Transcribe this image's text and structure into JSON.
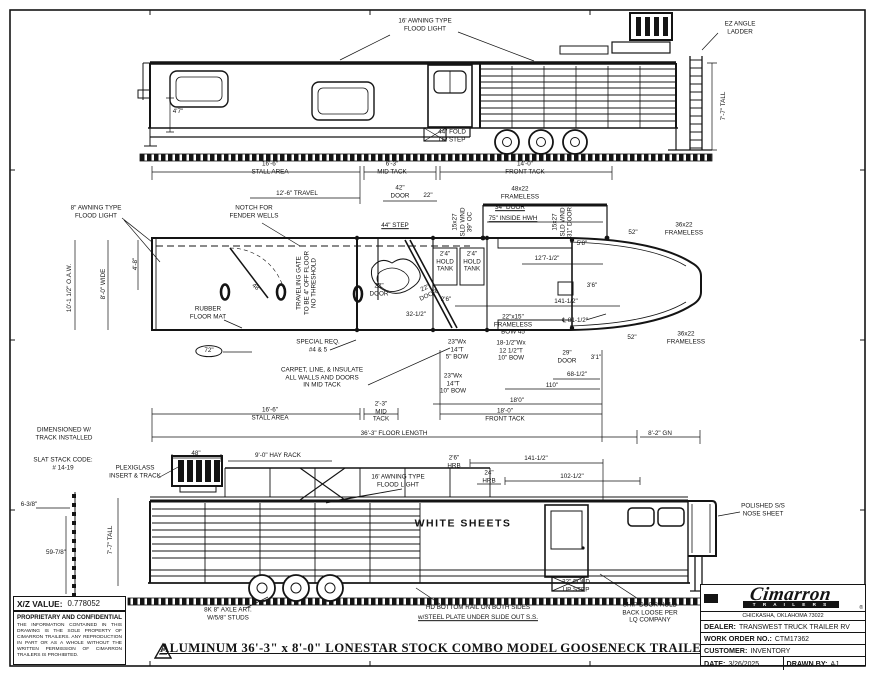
{
  "sheet": {
    "title": "ALUMINUM 36'-3\" x 8'-0\" LONESTAR STOCK COMBO MODEL GOOSENECK TRAILER",
    "xz_label": "X/Z VALUE:",
    "xz_value": "0.778052",
    "proprietary_title": "PROPRIETARY AND CONFIDENTIAL",
    "proprietary_text": "THE INFORMATION CONTAINED IN THIS DRAWING IS THE SOLE PROPERTY OF CIMARRON TRAILERS. ANY REPRODUCTION IN PART OR AS A WHOLE WITHOUT THE WRITTEN PERMISSION OF CIMARRON TRAILERS IS PROHIBITED."
  },
  "title_block": {
    "brand": "Cimarron",
    "brand_sub": "T R A I L E R S",
    "brand_reg": "®",
    "address": "CHICKASHA, OKLAHOMA 73022",
    "dealer_label": "DEALER:",
    "dealer": "TRANSWEST TRUCK TRAILER RV",
    "work_order_label": "WORK ORDER NO.:",
    "work_order": "CTM17362",
    "customer_label": "CUSTOMER:",
    "customer": "INVENTORY",
    "date_label": "DATE:",
    "date": "3/26/2025",
    "drawn_by_label": "DRAWN BY:",
    "drawn_by": "AJ"
  },
  "colors": {
    "ink": "#141414",
    "paper": "#ffffff"
  },
  "annotations": [
    {
      "text": "16' AWNING TYPE\nFLOOD LIGHT",
      "x": 425,
      "y": 25
    },
    {
      "text": "EZ ANGLE\nLADDER",
      "x": 740,
      "y": 28
    },
    {
      "text": "7'-7\" TALL",
      "x": 724,
      "y": 106,
      "rot": -90
    },
    {
      "text": "44\" FOLD\nUP STEP",
      "x": 452,
      "y": 136
    },
    {
      "text": "4'7\"",
      "x": 178,
      "y": 112
    },
    {
      "text": "16'-6\"\nSTALL AREA",
      "x": 270,
      "y": 168
    },
    {
      "text": "6'-3\"\nMID TACK",
      "x": 392,
      "y": 168
    },
    {
      "text": "14'-0\"\nFRONT TACK",
      "x": 525,
      "y": 168
    },
    {
      "text": "12'-6\" TRAVEL",
      "x": 297,
      "y": 194
    },
    {
      "text": "42\"\nDOOR",
      "x": 400,
      "y": 192
    },
    {
      "text": "22\"",
      "x": 428,
      "y": 196
    },
    {
      "text": "48x22\nFRAMELESS",
      "x": 520,
      "y": 193
    },
    {
      "text": "34\" DOOR",
      "x": 510,
      "y": 208,
      "style": "u"
    },
    {
      "text": "75\" INSIDE HWH",
      "x": 513,
      "y": 219,
      "style": "u"
    },
    {
      "text": "15x27\nSLD WND\n39\" OC",
      "x": 463,
      "y": 222,
      "rot": -90
    },
    {
      "text": "15x27\nSLD WND\n31\" DOOR",
      "x": 563,
      "y": 222,
      "rot": -90
    },
    {
      "text": "12'7-1/2\"",
      "x": 547,
      "y": 259
    },
    {
      "text": "8\" AWNING TYPE\nFLOOD LIGHT",
      "x": 96,
      "y": 212
    },
    {
      "text": "NOTCH FOR\nFENDER WELLS",
      "x": 254,
      "y": 212
    },
    {
      "text": "10'-1 1/2\" O.A.W.",
      "x": 70,
      "y": 288,
      "rot": -90
    },
    {
      "text": "8'-0\" WIDE",
      "x": 104,
      "y": 284,
      "rot": -90
    },
    {
      "text": "4'-8\"",
      "x": 136,
      "y": 264,
      "rot": -90
    },
    {
      "text": "48\"",
      "x": 256,
      "y": 288,
      "rot": 40
    },
    {
      "text": "TRAVELING GATE\nTO BE 4\" OFF FLOOR\nNO THRESHOLD",
      "x": 307,
      "y": 283,
      "rot": -90
    },
    {
      "text": "RUBBER\nFLOOR MAT",
      "x": 208,
      "y": 313
    },
    {
      "text": "72\"",
      "x": 209,
      "y": 351,
      "style": "balloon"
    },
    {
      "text": "SPECIAL REQ.\n#4 & 5",
      "x": 318,
      "y": 346
    },
    {
      "text": "CARPET, LINE, & INSULATE\nALL WALLS AND DOORS\nIN MID TACK",
      "x": 322,
      "y": 378
    },
    {
      "text": "2'4\"\nHOLD\nTANK",
      "x": 445,
      "y": 262
    },
    {
      "text": "2'4\"\nHOLD\nTANK",
      "x": 472,
      "y": 262
    },
    {
      "text": "44\" STEP",
      "x": 395,
      "y": 226,
      "style": "u"
    },
    {
      "text": "22\"\nDOOR",
      "x": 379,
      "y": 290
    },
    {
      "text": "22\"\nDOOR",
      "x": 427,
      "y": 292,
      "rot": -25
    },
    {
      "text": "32-1/2\"",
      "x": 416,
      "y": 315
    },
    {
      "text": "2'6\"",
      "x": 446,
      "y": 300
    },
    {
      "text": "141-1/2\"",
      "x": 566,
      "y": 302
    },
    {
      "text": "22\"x15\"\nFRAMELESS\nBOW 45",
      "x": 513,
      "y": 325
    },
    {
      "text": "℄ 81-1/2\"",
      "x": 575,
      "y": 321
    },
    {
      "text": "3'6\"",
      "x": 592,
      "y": 286
    },
    {
      "text": "5'8\"",
      "x": 582,
      "y": 244
    },
    {
      "text": "52\"",
      "x": 633,
      "y": 233
    },
    {
      "text": "36x22\nFRAMELESS",
      "x": 684,
      "y": 229
    },
    {
      "text": "52\"",
      "x": 632,
      "y": 338
    },
    {
      "text": "36x22\nFRAMELESS",
      "x": 686,
      "y": 338
    },
    {
      "text": "29\"\nDOOR",
      "x": 567,
      "y": 357
    },
    {
      "text": "3'1\"",
      "x": 596,
      "y": 358
    },
    {
      "text": "68-1/2\"",
      "x": 577,
      "y": 375
    },
    {
      "text": "110\"",
      "x": 552,
      "y": 386
    },
    {
      "text": "18'0\"",
      "x": 517,
      "y": 401
    },
    {
      "text": "23\"Wx\n14\"T\n5\" BOW",
      "x": 457,
      "y": 350
    },
    {
      "text": "18-1/2\"Wx\n12 1/2\"T\n10\" BOW",
      "x": 511,
      "y": 351
    },
    {
      "text": "23\"Wx\n14\"T\n10\" BOW",
      "x": 453,
      "y": 384
    },
    {
      "text": "16'-6\"\nSTALL AREA",
      "x": 270,
      "y": 414
    },
    {
      "text": "2'-3\"\nMID\nTACK",
      "x": 381,
      "y": 412
    },
    {
      "text": "18'-0\"\nFRONT TACK",
      "x": 505,
      "y": 415
    },
    {
      "text": "36'-3\" FLOOR LENGTH",
      "x": 394,
      "y": 434
    },
    {
      "text": "8'-2\" GN",
      "x": 660,
      "y": 434
    },
    {
      "text": "DIMENSIONED W/\nTRACK INSTALLED",
      "x": 64,
      "y": 434
    },
    {
      "text": "SLAT STACK CODE:\n# 14-19",
      "x": 63,
      "y": 464
    },
    {
      "text": "PLEXIGLASS\nINSERT & TRACK",
      "x": 135,
      "y": 472
    },
    {
      "text": "48\"",
      "x": 196,
      "y": 454
    },
    {
      "text": "9'-0\" HAY RACK",
      "x": 278,
      "y": 456
    },
    {
      "text": "16' AWNING TYPE\nFLOOD LIGHT",
      "x": 398,
      "y": 481
    },
    {
      "text": "2'6\"\nHRB",
      "x": 454,
      "y": 462
    },
    {
      "text": "24\"\nHRB",
      "x": 489,
      "y": 477
    },
    {
      "text": "141-1/2\"",
      "x": 536,
      "y": 459
    },
    {
      "text": "102-1/2\"",
      "x": 572,
      "y": 477
    },
    {
      "text": "WHITE SHEETS",
      "x": 463,
      "y": 524,
      "style": "big"
    },
    {
      "text": "POLISHED S/S\nNOSE SHEET",
      "x": 763,
      "y": 510
    },
    {
      "text": "6-3/8\"",
      "x": 29,
      "y": 505
    },
    {
      "text": "59-7/8\"",
      "x": 56,
      "y": 553
    },
    {
      "text": "7'-7\" TALL",
      "x": 111,
      "y": 540,
      "rot": -90
    },
    {
      "text": "8K 8\" AXLE ART.\nW/5/8\" STUDS",
      "x": 228,
      "y": 614
    },
    {
      "text": "HD BOTTOM RAIL ON BOTH SIDES",
      "x": 478,
      "y": 608
    },
    {
      "text": "w/STEEL PLATE UNDER SLIDE OUT S.S.",
      "x": 478,
      "y": 618,
      "style": "u"
    },
    {
      "text": "SHIP DOOR HOLD\nBACK LOOSE PER\nLQ COMPANY",
      "x": 650,
      "y": 613
    },
    {
      "text": "32\" FOLD\nUP STEP",
      "x": 576,
      "y": 586
    }
  ]
}
